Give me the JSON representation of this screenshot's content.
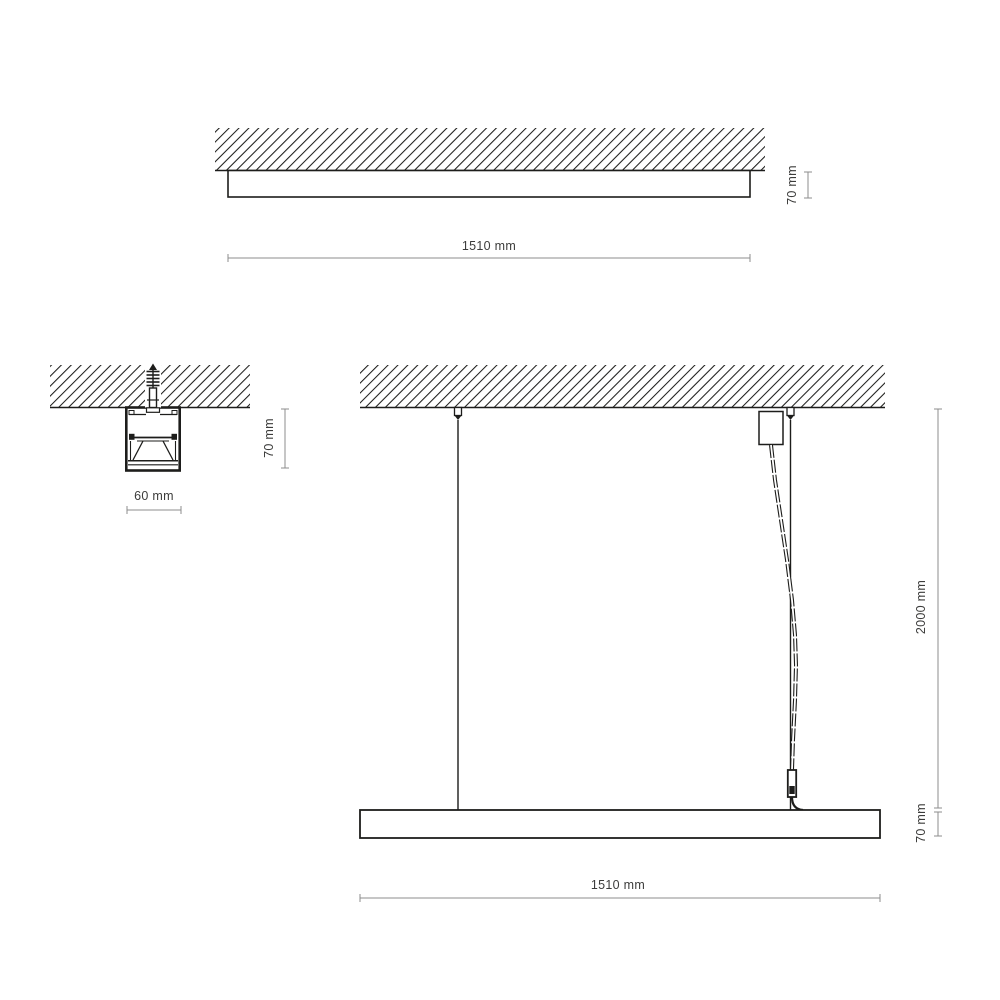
{
  "document": {
    "type": "luminaire-technical-drawing",
    "background": "#ffffff"
  },
  "colors": {
    "drawing_line": "#1d1d1b",
    "dimension_line": "#8c8c8c",
    "label_text": "#3c3c3b"
  },
  "views": {
    "surface_mounted": {
      "length_label": "1510 mm",
      "height_label": "70 mm"
    },
    "cross_section": {
      "width_label": "60 mm",
      "height_label": "70 mm"
    },
    "suspended": {
      "length_label": "1510 mm",
      "suspension_label": "2000 mm",
      "height_label": "70 mm"
    }
  }
}
